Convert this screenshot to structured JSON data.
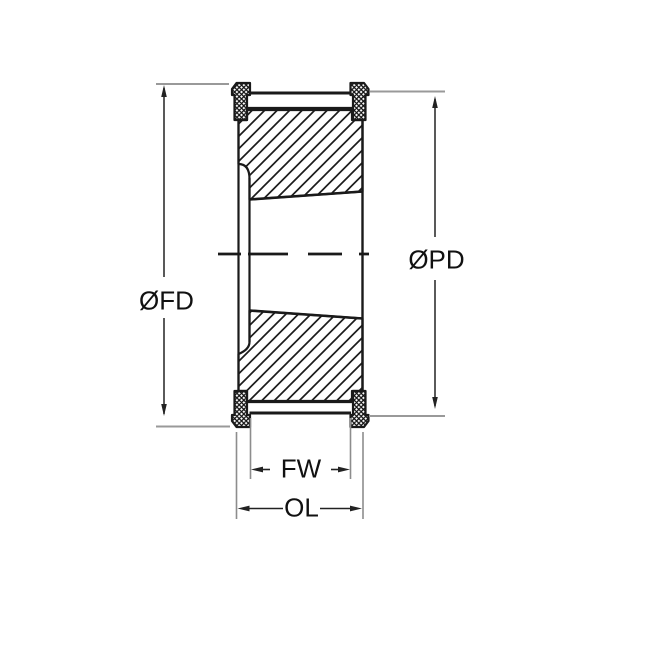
{
  "drawing": {
    "kind": "pulley-cross-section-technical-drawing",
    "labels": {
      "fd": "ØFD",
      "pd": "ØPD",
      "fw": "FW",
      "ol": "OL"
    },
    "colors": {
      "outline": "#1a1a1a",
      "dimension_line": "#222222",
      "extension_line": "#999999",
      "background": "#ffffff"
    }
  }
}
